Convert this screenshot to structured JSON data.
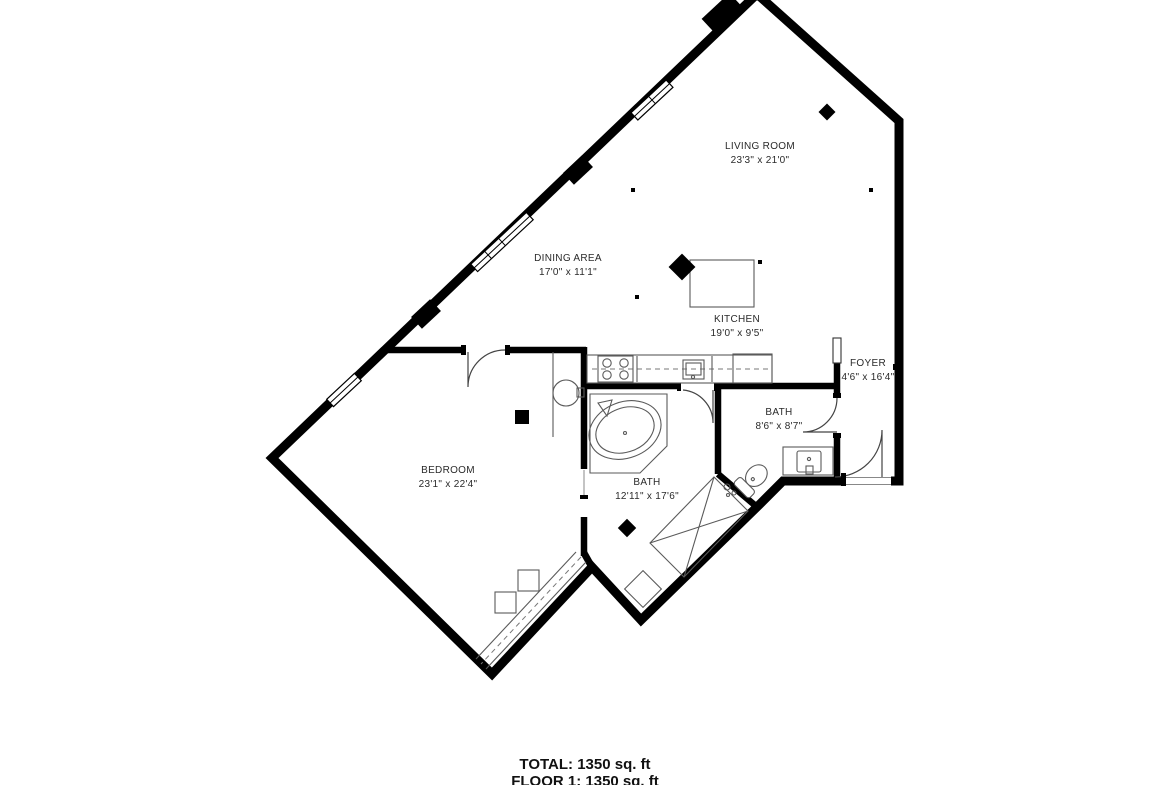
{
  "floorplan": {
    "rooms": [
      {
        "name": "LIVING ROOM",
        "dims": "23'3\" x 21'0\""
      },
      {
        "name": "DINING AREA",
        "dims": "17'0\" x 11'1\""
      },
      {
        "name": "KITCHEN",
        "dims": "19'0\" x 9'5\""
      },
      {
        "name": "FOYER",
        "dims": "4'6\" x 16'4\""
      },
      {
        "name": "BATH",
        "dims": "8'6\" x 8'7\""
      },
      {
        "name": "BEDROOM",
        "dims": "23'1\" x 22'4\""
      },
      {
        "name": "BATH",
        "dims": "12'11\" x 17'6\""
      }
    ],
    "summary": {
      "total": "TOTAL: 1350 sq. ft",
      "floor": "FLOOR 1: 1350 sq. ft"
    },
    "colors": {
      "wall": "#000000",
      "fixture": "#5a5a5a",
      "background": "#ffffff",
      "text": "#2a2a2a"
    }
  }
}
